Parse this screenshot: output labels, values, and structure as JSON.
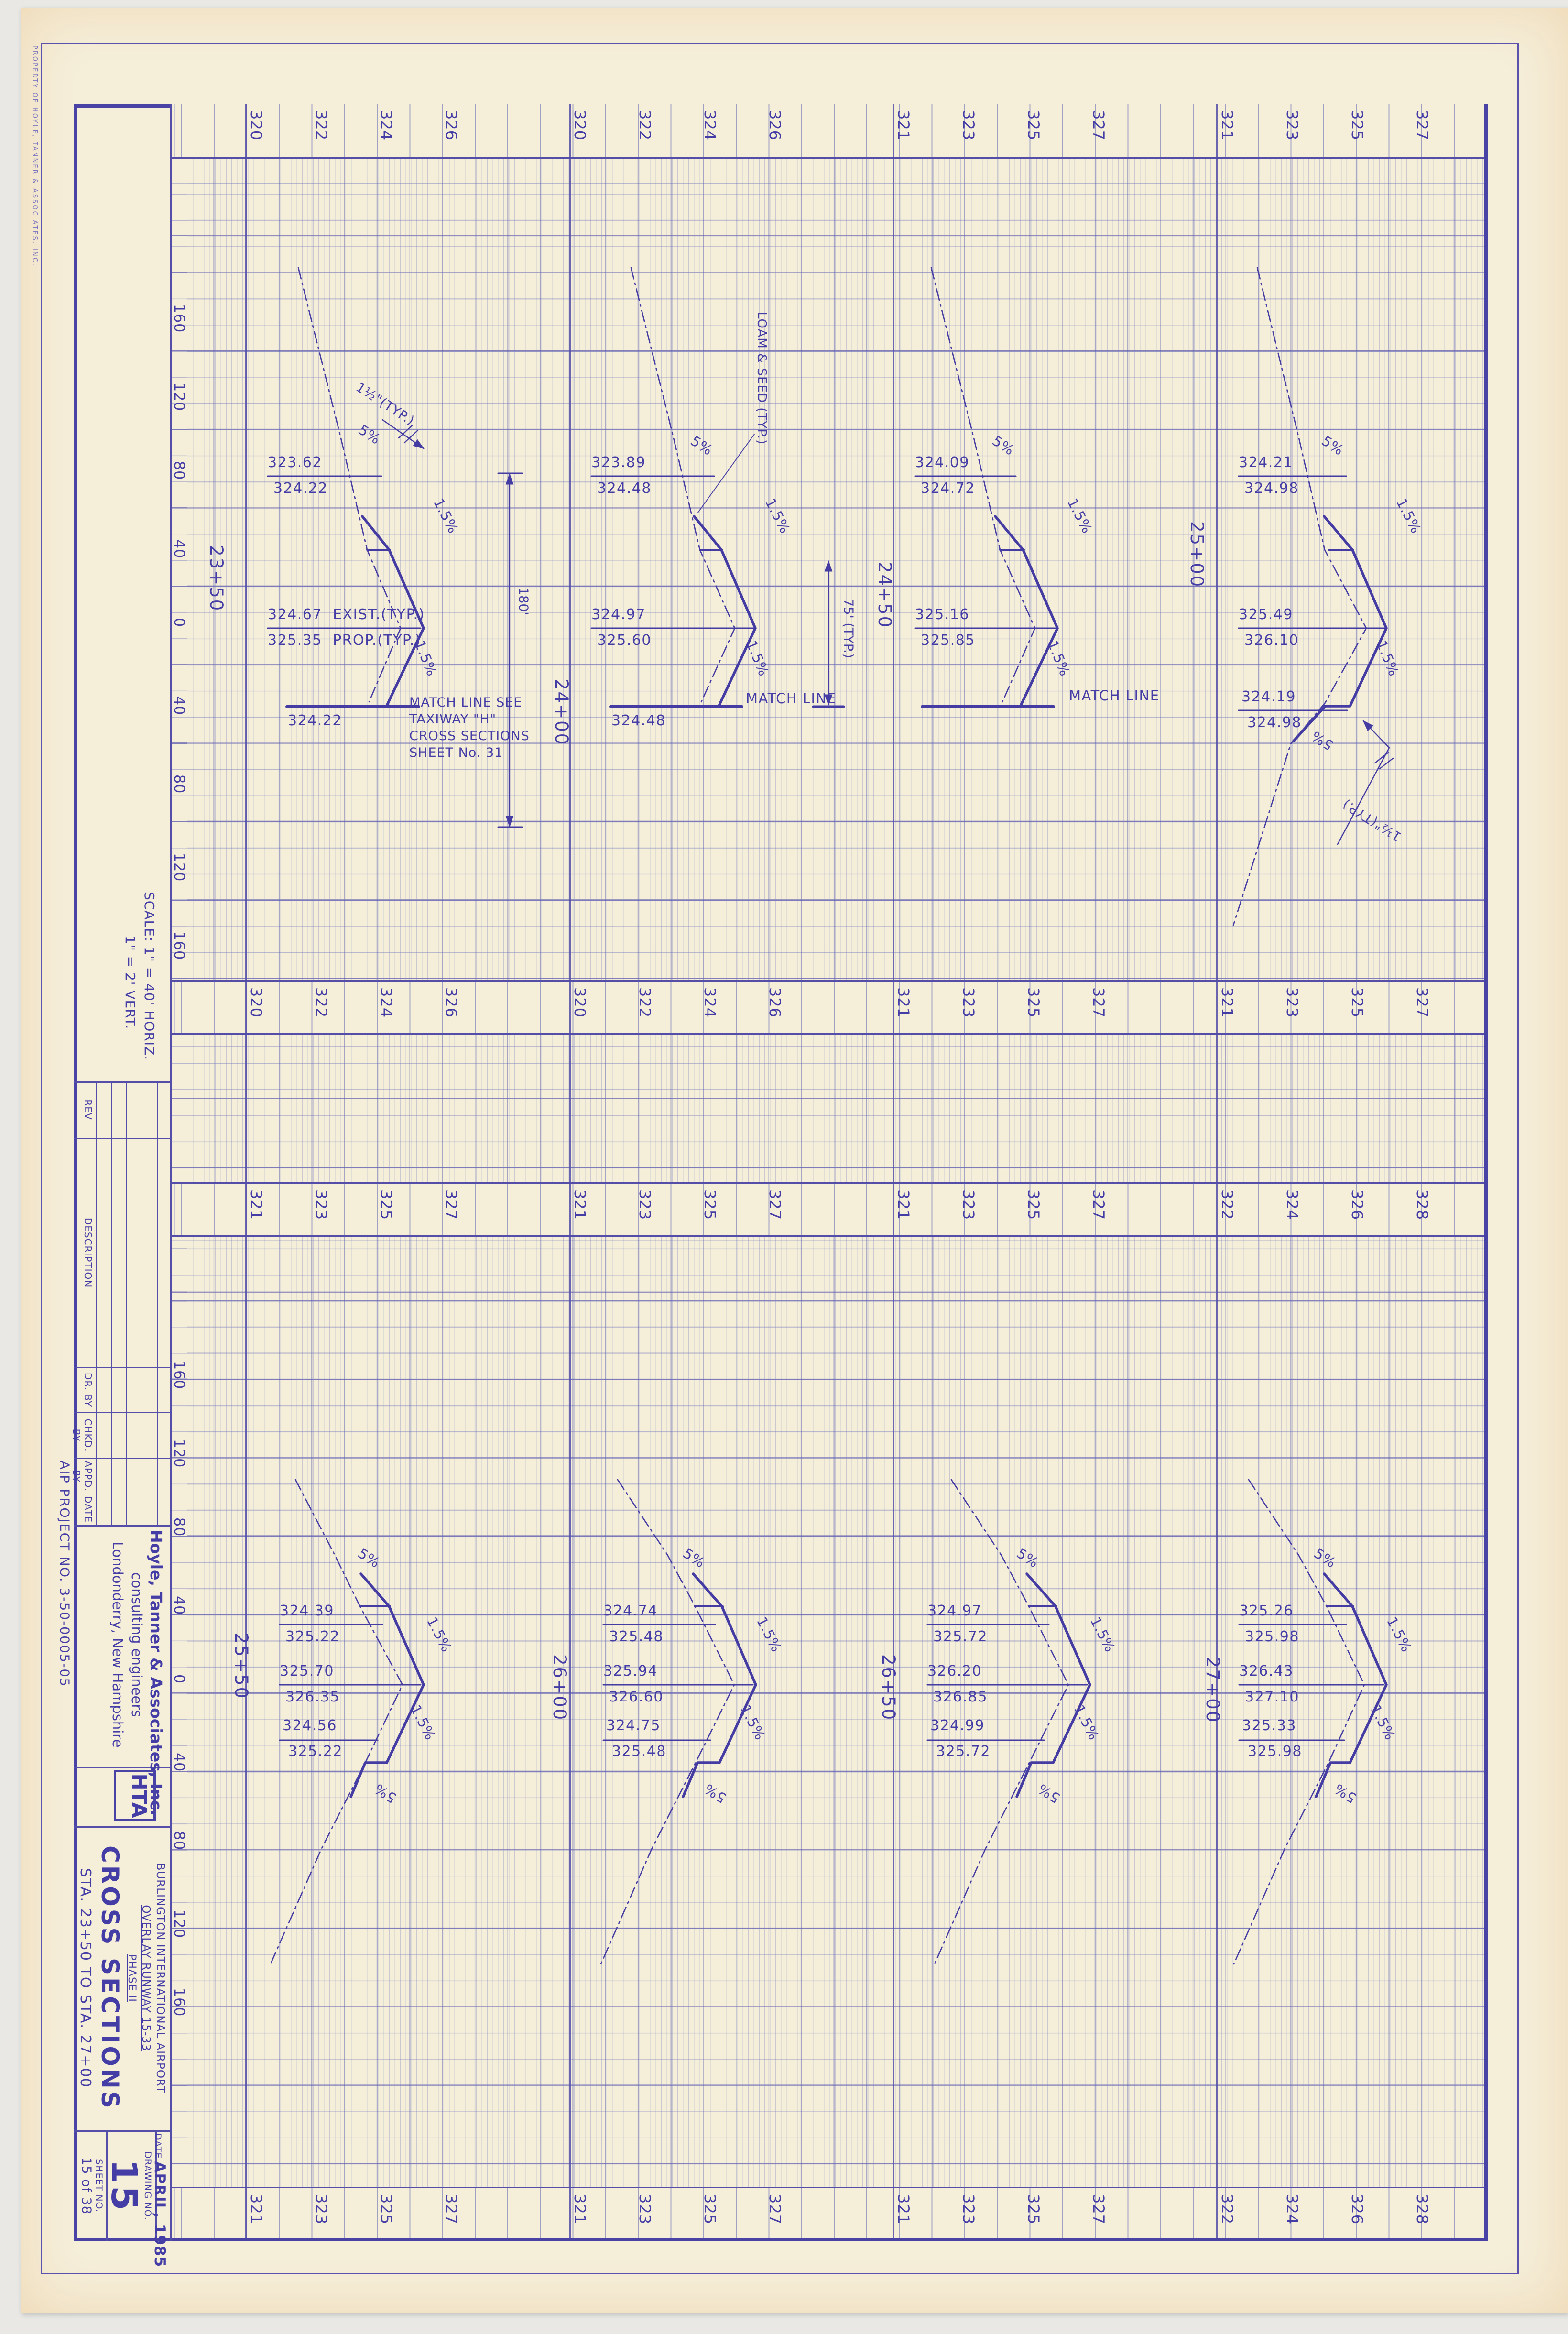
{
  "margins": {
    "property_note": "PROPERTY OF HOYLE, TANNER & ASSOCIATES, INC.",
    "aip_project_no": "AIP  PROJECT  NO.  3-50-0005-05"
  },
  "scale_note": {
    "line1": "SCALE:  1\" = 40' HORIZ.",
    "line2": "1\" =  2'  VERT."
  },
  "rev_table": {
    "headers": [
      "REV",
      "DESCRIPTION",
      "DR. BY",
      "CHKD. BY",
      "APPD. BY",
      "DATE"
    ]
  },
  "title_block": {
    "firm": {
      "name": "Hoyle, Tanner & Associates, Inc.",
      "line2": "consulting engineers",
      "line3": "Londonderry, New Hampshire"
    },
    "logo": {
      "letters": "HTA"
    },
    "project": {
      "line1": "BURLINGTON  INTERNATIONAL  AIRPORT",
      "line2": "OVERLAY  RUNWAY  15-33",
      "line3": "PHASE II"
    },
    "sheet_title": "CROSS   SECTIONS",
    "sheet_range": "STA. 23+50  TO  STA. 27+00",
    "date_label": "DATE",
    "date_value": "APRIL, 1985",
    "drawing_label": "DRAWING  NO.",
    "drawing_no": "15",
    "sheet_label": "SHEET  NO.",
    "sheet_no": "15 of 38"
  },
  "labels": {
    "slope5": "5%",
    "slope15": "1.5%",
    "exist_note": "EXIST.(TYP.)",
    "prop_note": "PROP.(TYP.)",
    "match_line": "MATCH LINE",
    "loam_seed": "LOAM & SEED (TYP.)",
    "overlay_callout": "1½\"(TYP.)",
    "dim_180": "180'",
    "dim_75": "75' (TYP.)"
  },
  "elevations": {
    "upper_bands": [
      "320",
      "322",
      "324",
      "326",
      "320",
      "322",
      "324",
      "326",
      "321",
      "323",
      "325",
      "327",
      "321",
      "323",
      "325",
      "327"
    ],
    "lower_bands": [
      "321",
      "323",
      "325",
      "327",
      "321",
      "323",
      "325",
      "327",
      "321",
      "323",
      "325",
      "327",
      "322",
      "324",
      "326",
      "328"
    ],
    "offsets": [
      "160",
      "120",
      "80",
      "40",
      "0",
      "40",
      "80",
      "120",
      "160"
    ]
  },
  "sections": [
    {
      "station": "23+50",
      "top_exist": "323.62",
      "top_prop": "324.22",
      "cl_exist": "324.67",
      "cl_prop": "325.35",
      "bottom_value": "324.22",
      "match_note": [
        "MATCH LINE SEE",
        "TAXIWAY \"H\"",
        "CROSS SECTIONS",
        "SHEET No. 31"
      ]
    },
    {
      "station": "24+00",
      "top_exist": "323.89",
      "top_prop": "324.48",
      "cl_exist": "324.97",
      "cl_prop": "325.60",
      "bottom_value": "324.48"
    },
    {
      "station": "24+50",
      "top_exist": "324.09",
      "top_prop": "324.72",
      "cl_exist": "325.16",
      "cl_prop": "325.85"
    },
    {
      "station": "25+00",
      "top_exist": "324.21",
      "top_prop": "324.98",
      "cl_exist": "325.49",
      "cl_prop": "326.10",
      "bot_exist": "324.19",
      "bot_prop": "324.98"
    },
    {
      "station": "25+50",
      "top_exist": "324.39",
      "top_prop": "325.22",
      "cl_exist": "325.70",
      "cl_prop": "326.35",
      "bot_exist": "324.56",
      "bot_prop": "325.22"
    },
    {
      "station": "26+00",
      "top_exist": "324.74",
      "top_prop": "325.48",
      "cl_exist": "325.94",
      "cl_prop": "326.60",
      "bot_exist": "324.75",
      "bot_prop": "325.48"
    },
    {
      "station": "26+50",
      "top_exist": "324.97",
      "top_prop": "325.72",
      "cl_exist": "326.20",
      "cl_prop": "326.85",
      "bot_exist": "324.99",
      "bot_prop": "325.72"
    },
    {
      "station": "27+00",
      "top_exist": "325.26",
      "top_prop": "325.98",
      "cl_exist": "326.43",
      "cl_prop": "327.10",
      "bot_exist": "325.33",
      "bot_prop": "325.98"
    }
  ]
}
